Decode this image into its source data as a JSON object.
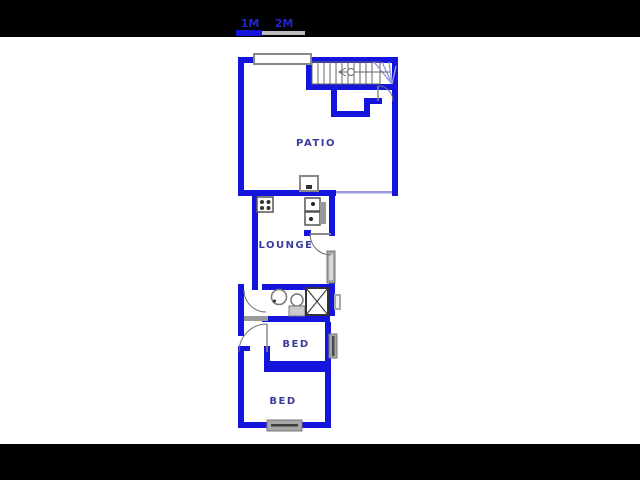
{
  "scale_bar": {
    "labels": [
      "1M",
      "2M"
    ]
  },
  "rooms": {
    "patio": {
      "label": "PATIO"
    },
    "lounge": {
      "label": "LOUNGE"
    },
    "bed1": {
      "label": "BED"
    },
    "bed2": {
      "label": "BED"
    }
  },
  "colors": {
    "wall": "#1414dd",
    "thin_line": "#9a9ae0",
    "window_gray": "#a6a6a6",
    "label_text": "#3c3c9c",
    "scale_text": "#2424cc",
    "letterbox": "#000000",
    "canvas": "#ffffff"
  }
}
